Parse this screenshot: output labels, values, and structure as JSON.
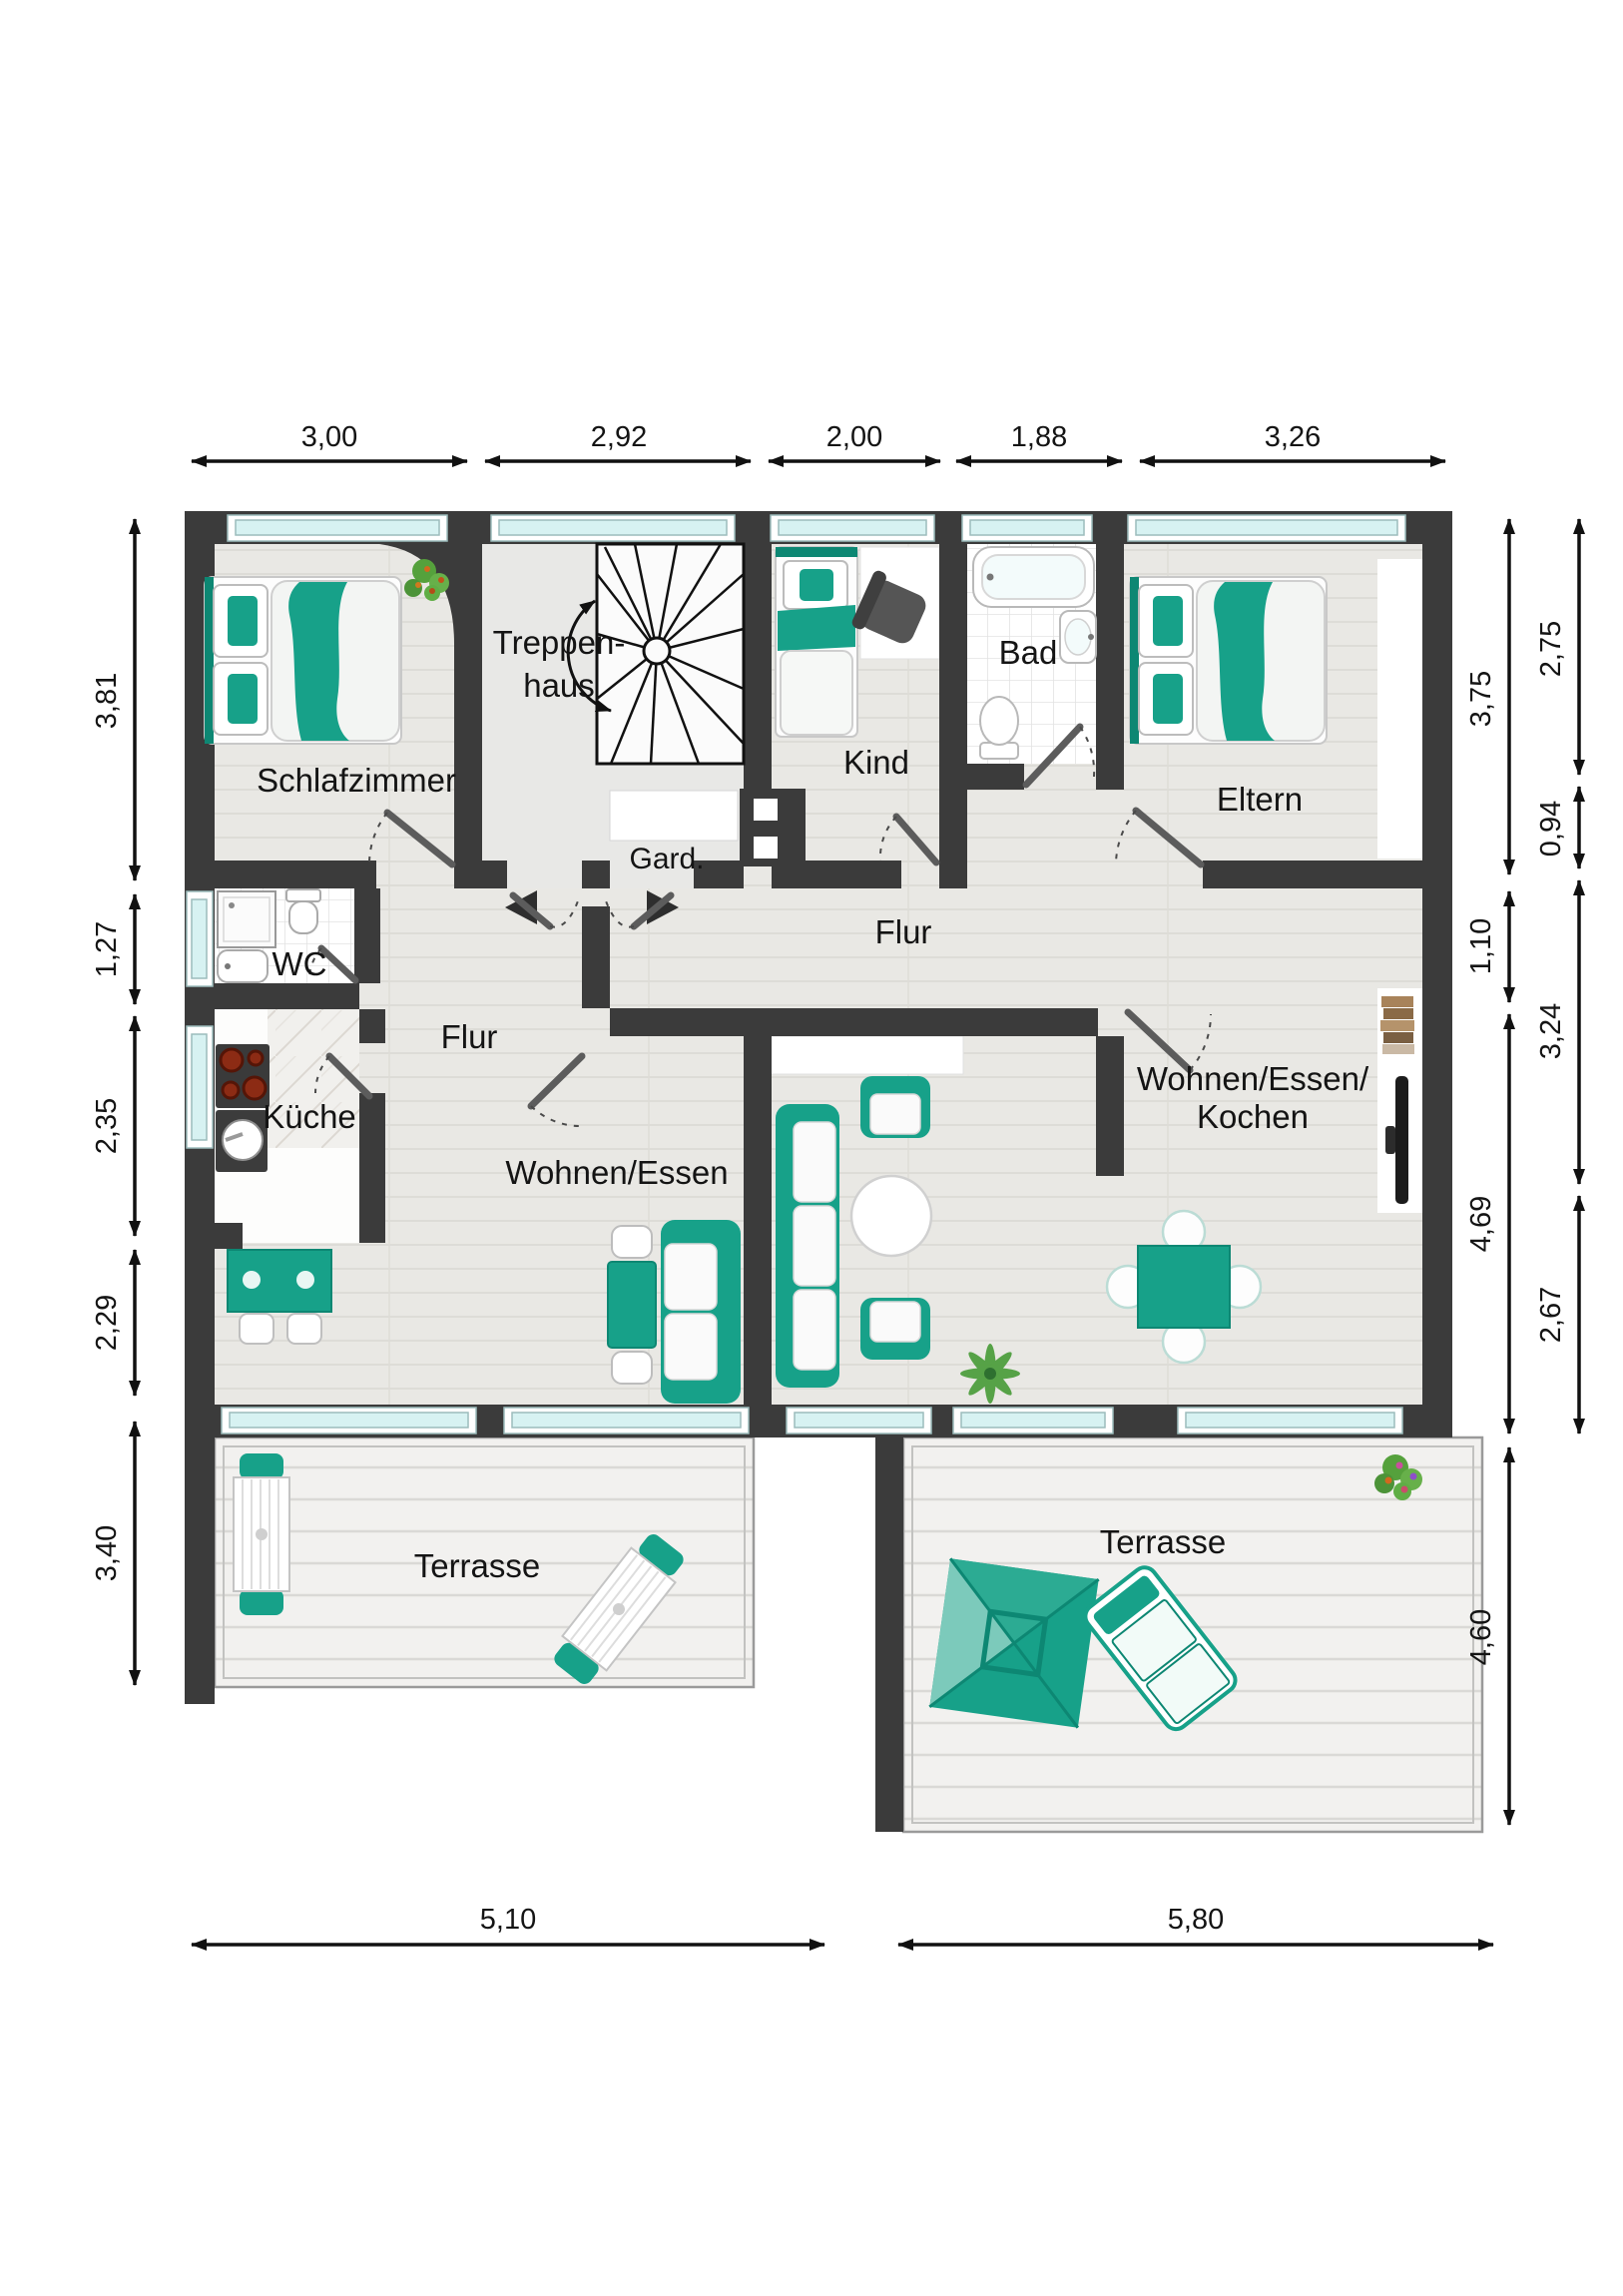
{
  "rooms": {
    "schlafzimmer": "Schlafzimmer",
    "treppenhaus_line1": "Treppen-",
    "treppenhaus_line2": "haus",
    "gard": "Gard.",
    "kind": "Kind",
    "bad": "Bad",
    "eltern": "Eltern",
    "wc": "WC",
    "kueche": "Küche",
    "flur_left": "Flur",
    "flur_center": "Flur",
    "wohnen_essen": "Wohnen/Essen",
    "wek_line1": "Wohnen/Essen/",
    "wek_line2": "Kochen",
    "terrasse_left": "Terrasse",
    "terrasse_right": "Terrasse"
  },
  "dimensions": {
    "top": [
      "3,00",
      "2,92",
      "2,00",
      "1,88",
      "3,26"
    ],
    "left": [
      "3,81",
      "1,27",
      "2,35",
      "2,29",
      "3,40"
    ],
    "right_inner": [
      "3,75",
      "1,10",
      "4,69",
      "4,60"
    ],
    "right_outer": [
      "2,75",
      "0,94",
      "3,24",
      "2,67"
    ],
    "bottom": [
      "5,10",
      "5,80"
    ]
  },
  "colors": {
    "wall": "#3b3b3b",
    "accent_teal": "#17a189",
    "accent_teal_dark": "#0d8773",
    "window_glass": "#d7f2f2",
    "wood_floor": "#e9e8e4",
    "hall_floor": "#e8e8e6",
    "deck": "#f2f1ef"
  }
}
